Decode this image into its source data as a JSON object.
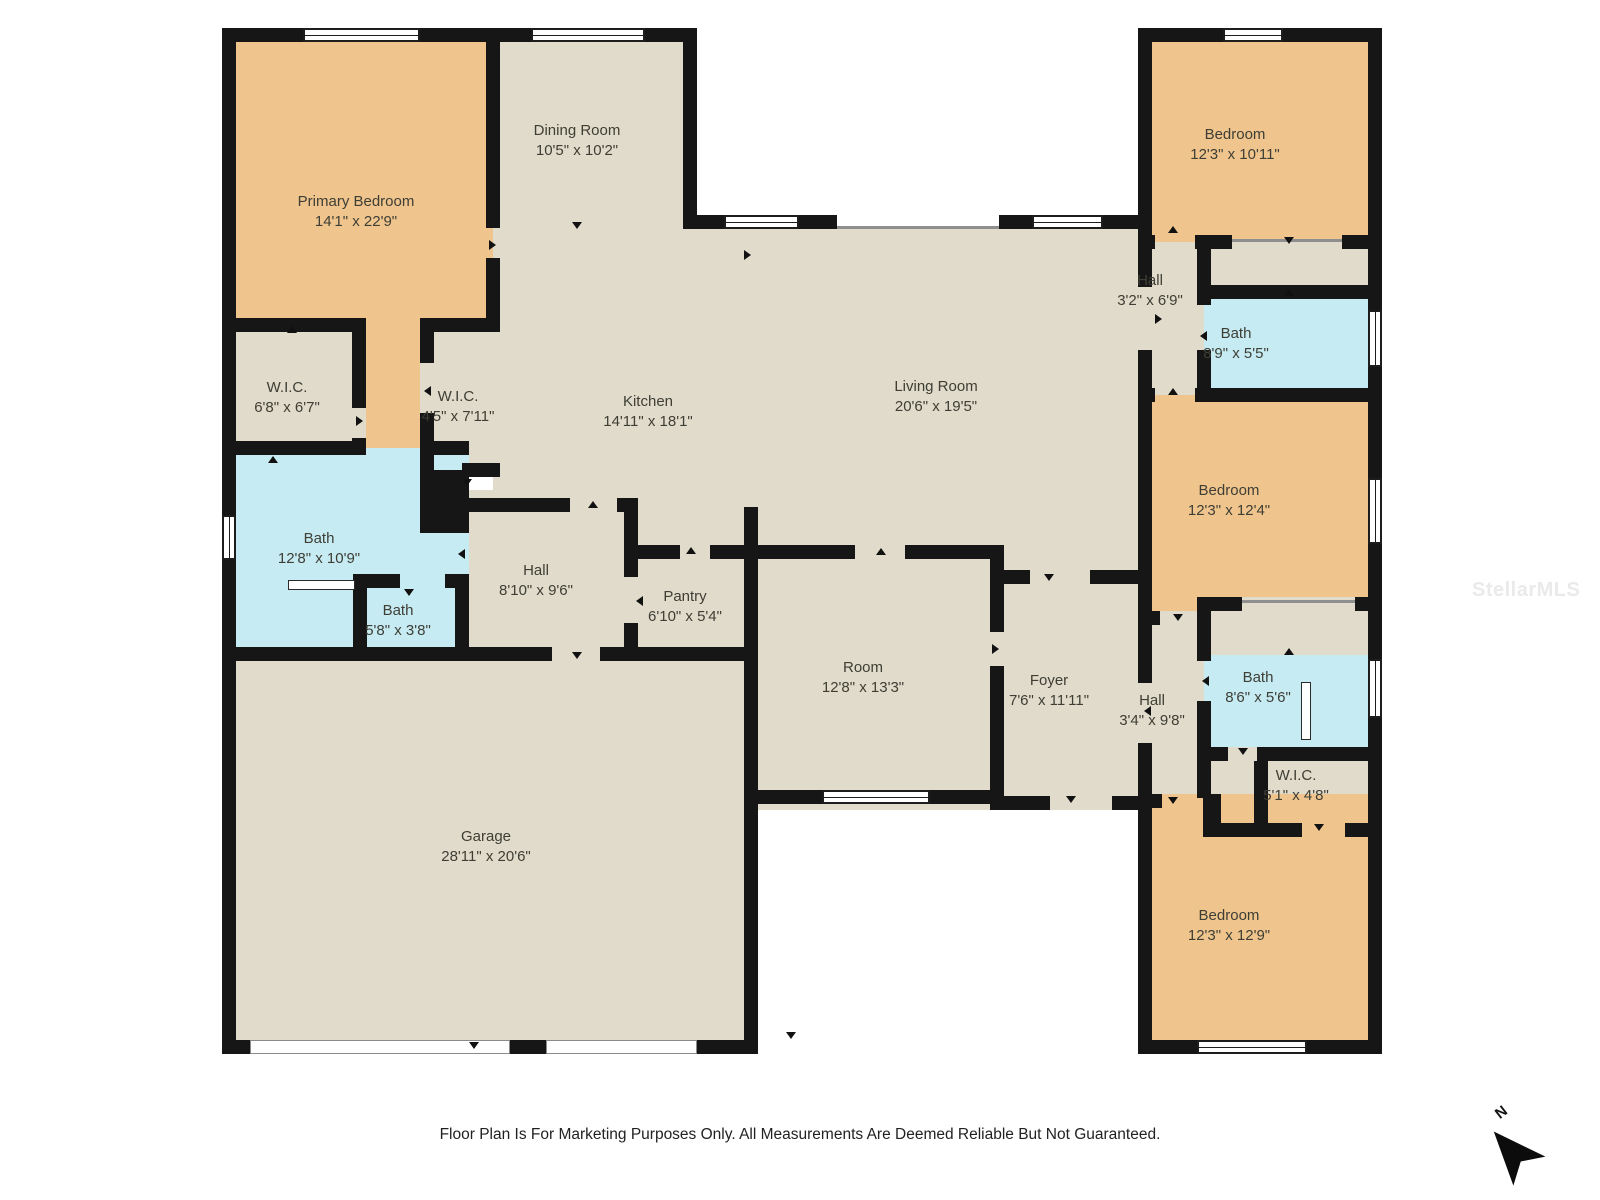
{
  "colors": {
    "wall": "#161616",
    "bedroom_fill": "#efc58d",
    "common_fill": "#e0dbca",
    "bath_fill": "#c6ebf3"
  },
  "rooms": {
    "primary_bedroom": {
      "label": "Primary Bedroom",
      "dims": "14'1\" x 22'9\""
    },
    "dining_room": {
      "label": "Dining Room",
      "dims": "10'5\" x 10'2\""
    },
    "kitchen": {
      "label": "Kitchen",
      "dims": "14'11\" x 18'1\""
    },
    "living_room": {
      "label": "Living Room",
      "dims": "20'6\" x 19'5\""
    },
    "wic_primary": {
      "label": "W.I.C.",
      "dims": "6'8\" x 6'7\""
    },
    "wic_hall": {
      "label": "W.I.C.",
      "dims": "4'5\" x 7'11\""
    },
    "bath_primary": {
      "label": "Bath",
      "dims": "12'8\" x 10'9\""
    },
    "bath_secondary": {
      "label": "Bath",
      "dims": "5'8\" x 3'8\""
    },
    "hall_primary": {
      "label": "Hall",
      "dims": "8'10\" x 9'6\""
    },
    "pantry": {
      "label": "Pantry",
      "dims": "6'10\" x 5'4\""
    },
    "room": {
      "label": "Room",
      "dims": "12'8\" x 13'3\""
    },
    "foyer": {
      "label": "Foyer",
      "dims": "7'6\" x 11'11\""
    },
    "garage": {
      "label": "Garage",
      "dims": "28'11\" x 20'6\""
    },
    "bedroom_top_right": {
      "label": "Bedroom",
      "dims": "12'3\" x 10'11\""
    },
    "hall_top_right": {
      "label": "Hall",
      "dims": "3'2\" x 6'9\""
    },
    "bath_top_right": {
      "label": "Bath",
      "dims": "8'9\" x 5'5\""
    },
    "bedroom_mid_right": {
      "label": "Bedroom",
      "dims": "12'3\" x 12'4\""
    },
    "hall_mid_right": {
      "label": "Hall",
      "dims": "3'4\" x 9'8\""
    },
    "bath_mid_right": {
      "label": "Bath",
      "dims": "8'6\" x 5'6\""
    },
    "wic_mid_right": {
      "label": "W.I.C.",
      "dims": "5'1\" x 4'8\""
    },
    "bedroom_bottom_right": {
      "label": "Bedroom",
      "dims": "12'3\" x 12'9\""
    }
  },
  "footer": {
    "disclaimer": "Floor Plan Is For Marketing Purposes Only. All Measurements Are Deemed Reliable But Not Guaranteed."
  },
  "watermark": "StellarMLS",
  "compass": {
    "north_label": "N"
  }
}
